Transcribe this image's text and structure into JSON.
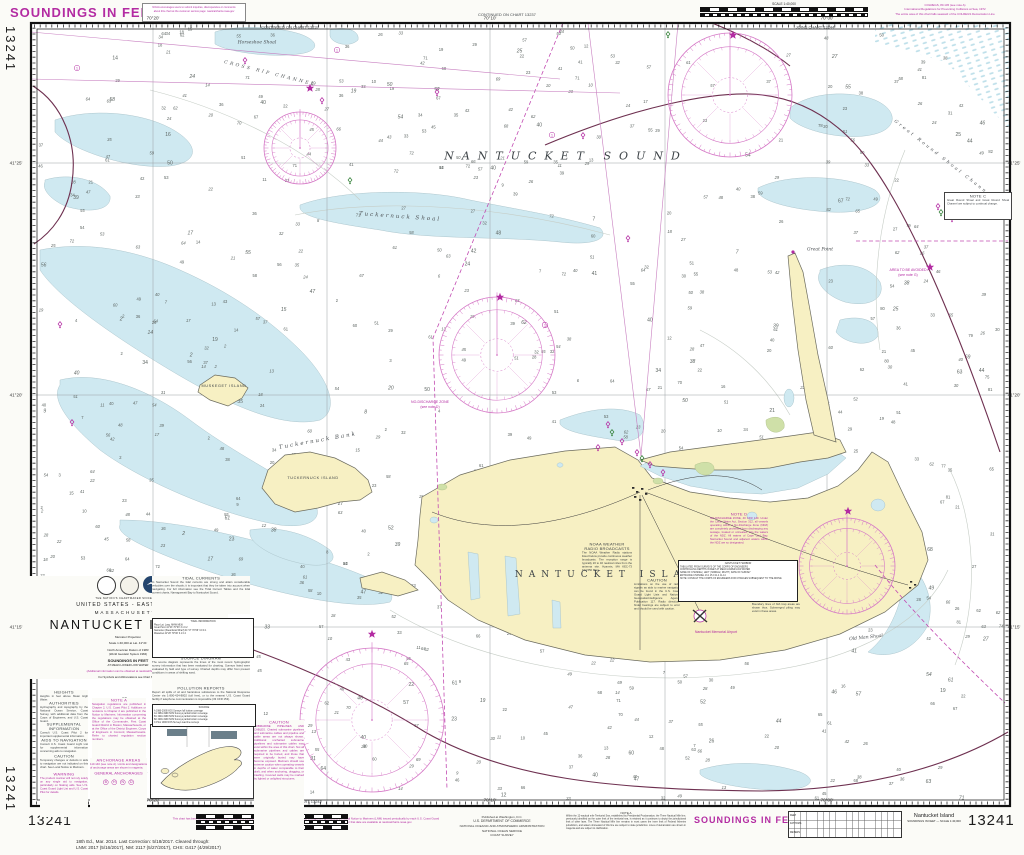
{
  "page": {
    "chart_number": "13241",
    "soundings_margin": "SOUNDINGS IN FEET"
  },
  "colors": {
    "magenta": "#b32ba2",
    "rose": "#d578c6",
    "dashed": "#c24cb2",
    "water": "#cfe9f1",
    "land": "#f7f0c3",
    "marsh": "#cfe0a8",
    "cable": "#6e3050",
    "sounding": "#5e6663",
    "paper": "#fbfbf7"
  },
  "top": {
    "note_box_line1": "NOAA encourages users to submit inquiries, discrepancies or comments",
    "note_box_line2": "about this chart at the customer service page: nauticalcharts.noaa.gov",
    "continued": "CONTINUED ON CHART 13237",
    "joins": "JOINS CHART 13244",
    "scale_label": "SCALE  1:40,000",
    "colregs_line1": "COLREGS, 80.145 (see note A)",
    "colregs_line2": "International Regulations for Preventing Collisions at Sea, 1972",
    "colregs_line3": "The entire area of this chart falls seaward of the COLREGS Demarcation Line"
  },
  "title_block": {
    "motto": "THE NATION'S CHARTMAKER SINCE 1807",
    "region1": "UNITED STATES - EAST COAST",
    "region2": "MASSACHUSETTS",
    "title": "NANTUCKET ISLAND",
    "projection": "Mercator Projection",
    "scale": "Scale 1:40,000 at Lat. 41°21'",
    "datum1": "North American Datum of 1983",
    "datum2": "(World Geodetic System 1984)",
    "sound_unit": "SOUNDINGS IN FEET",
    "sound_datum": "AT MEAN LOWER LOW WATER",
    "web_note": "(Additional information can be obtained at nauticalcharts.noaa.gov)",
    "symbols_note": "For Symbols and Abbreviations see Chart No. 1"
  },
  "bottom": {
    "chart_number_left": "13241",
    "chart_number_right": "13241",
    "soundings": "SOUNDINGS IN FEET",
    "caution_title": "CAUTION",
    "caution_body": "This chart has been corrected from the Notice to Mariners (NM) published weekly by the National Geospatial-Intelligence Agency, and the Local Notice to Mariners (LNM) issued periodically by each U.S. Coast Guard district to the date shown in the lower left hand corner. Chart updates contained in the Notice to Mariners and issued after that date are available at nauticalcharts.noaa.gov.",
    "publisher1": "Published at Washington, D.C.",
    "publisher2": "U.S. DEPARTMENT OF COMMERCE",
    "publisher3": "NATIONAL OCEANIC AND ATMOSPHERIC ADMINISTRATION",
    "publisher4": "NATIONAL OCEAN SERVICE",
    "publisher5": "COAST SURVEY",
    "note_a_title": "NOTE A",
    "note_a_body": "Within the 12-nautical mile Territorial Sea, established by Presidential Proclamation, the Three Nautical Mile line, previously identified as the outer limit of the territorial sea, is retained as it continues to depict the jurisdictional limit of other laws. The Three Nautical Mile line remains in most cases the inner limit of Federal fisheries jurisdiction, and waters shoreward of this line are subject to state jurisdiction. Lines of demarcation are shown in magenta and are subject to clarification.",
    "edition_line1": "18th Ed., Mar. 2014. Last Correction: 5/18/2017. Cleared through:",
    "edition_line2": "LNM: 2017 (5/16/2017), NM: 2117 (5/27/2017), CHS: G417 (4/29/2017)",
    "right_title1": "Nantucket Island",
    "right_title2": "SOUNDINGS IN FEET — SCALE 1:40,000",
    "continued": "CONTINUED ON CHART 13242",
    "scale_label": "SCALE  1:40,000",
    "scale_units1": "Nautical Miles",
    "scale_units2": "Yards",
    "scale_units3": "Meters",
    "conv_row1": "FEET",
    "conv_row2": "FATHOMS",
    "conv_row3": "METERS"
  },
  "labels": [
    {
      "t": "NANTUCKET SOUND",
      "x": 566,
      "y": 156,
      "c": "sea-major",
      "r": 0
    },
    {
      "t": "NANTUCKET ISLAND",
      "x": 614,
      "y": 575,
      "c": "land-major",
      "r": 0
    },
    {
      "t": "Horseshoe Shoal",
      "x": 257,
      "y": 43,
      "c": "shoal",
      "r": 0
    },
    {
      "t": "CROSS RIP CHANNEL",
      "x": 270,
      "y": 74,
      "c": "channel",
      "r": 14
    },
    {
      "t": "Tuckernuck Shoal",
      "x": 400,
      "y": 217,
      "c": "shoal-lg",
      "r": 4
    },
    {
      "t": "Tuckernuck Bank",
      "x": 318,
      "y": 441,
      "c": "shoal-lg",
      "r": -10
    },
    {
      "t": "MUSKEGET ISLAND",
      "x": 224,
      "y": 386,
      "c": "isl",
      "r": 0
    },
    {
      "t": "TUCKERNUCK ISLAND",
      "x": 313,
      "y": 478,
      "c": "isl",
      "r": 0
    },
    {
      "t": "Great Point",
      "x": 820,
      "y": 250,
      "c": "shoal",
      "r": 0
    },
    {
      "t": "Old Man Shoal",
      "x": 866,
      "y": 638,
      "c": "shoal",
      "r": -6
    },
    {
      "t": "Great Round Shoal Channel",
      "x": 944,
      "y": 160,
      "c": "channel",
      "r": 38
    },
    {
      "t": "Nantucket Memorial Airport",
      "x": 716,
      "y": 632,
      "c": "tiny-mag",
      "r": 0
    },
    {
      "t": "NO-DISCHARGE ZONE",
      "x": 430,
      "y": 402,
      "c": "tiny-mag",
      "r": 0
    },
    {
      "t": "(see note D)",
      "x": 430,
      "y": 407,
      "c": "tiny-mag",
      "r": 0
    },
    {
      "t": "AREA TO BE AVOIDED",
      "x": 908,
      "y": 270,
      "c": "tiny-mag",
      "r": 0
    },
    {
      "t": "(see note G)",
      "x": 908,
      "y": 275,
      "c": "tiny-mag",
      "r": 0
    },
    {
      "t": "CONTINUED ON CHART 13237",
      "x": 290,
      "y": 27,
      "c": "tinytext",
      "r": 0
    },
    {
      "t": "JOINS CHART 13244",
      "x": 815,
      "y": 27,
      "c": "tinytext",
      "r": 0
    }
  ],
  "edge_labels": [
    {
      "t": "70°20'",
      "x": 153,
      "y": 18
    },
    {
      "t": "70°10'",
      "x": 490,
      "y": 18
    },
    {
      "t": "70°00'",
      "x": 827,
      "y": 18
    },
    {
      "t": "70°20'",
      "x": 153,
      "y": 800
    },
    {
      "t": "70°10'",
      "x": 490,
      "y": 800
    },
    {
      "t": "70°00'",
      "x": 827,
      "y": 800
    },
    {
      "t": "41°25'",
      "x": 16,
      "y": 163
    },
    {
      "t": "41°20'",
      "x": 16,
      "y": 395
    },
    {
      "t": "41°15'",
      "x": 16,
      "y": 627
    },
    {
      "t": "41°25'",
      "x": 1014,
      "y": 163
    },
    {
      "t": "41°20'",
      "x": 1014,
      "y": 395
    },
    {
      "t": "41°15'",
      "x": 1014,
      "y": 627
    }
  ],
  "notes": [
    {
      "x": 40,
      "y": 690,
      "w": 48,
      "color": "k",
      "bg": "p",
      "title": "HEIGHTS",
      "body": "Heights in feet above Mean High Water."
    },
    {
      "x": 40,
      "y": 701,
      "w": 48,
      "color": "k",
      "bg": "p",
      "title": "AUTHORITIES",
      "body": "Hydrography and topography by the National Ocean Service, Coast Survey, with additional data from the Corps of Engineers, and U.S. Coast Guard."
    },
    {
      "x": 40,
      "y": 722,
      "w": 48,
      "color": "k",
      "bg": "p",
      "title": "SUPPLEMENTAL INFORMATION",
      "body": "Consult U.S. Coast Pilot 2 for important supplemental information."
    },
    {
      "x": 40,
      "y": 738,
      "w": 48,
      "color": "k",
      "bg": "p",
      "title": "AIDS TO NAVIGATION",
      "body": "Consult U.S. Coast Guard Light List for supplemental information concerning aids to navigation."
    },
    {
      "x": 40,
      "y": 754,
      "w": 48,
      "color": "k",
      "bg": "p",
      "title": "CAUTION",
      "body": "Temporary changes or defects in aids to navigation are not indicated on this chart. See Local Notice to Mariners."
    },
    {
      "x": 40,
      "y": 772,
      "w": 48,
      "color": "m",
      "bg": "p",
      "title": "WARNING",
      "body": "The prudent mariner will not rely solely on any single aid to navigation, particularly on floating aids. See U.S. Coast Guard Light List and U.S. Coast Pilot for details."
    },
    {
      "x": 92,
      "y": 698,
      "w": 54,
      "color": "m",
      "bg": "p",
      "title": "NOTE A",
      "body": "Navigation regulations are published in Chapter 2, U.S. Coast Pilot 2. Additions or revisions to Chapter 2 are published in the Notice to Mariners. Information concerning the regulations may be obtained at the Office of the Commander, First Coast Guard District in Boston, Massachusetts, or at the Office of the District Engineer, Corps of Engineers in Concord, Massachusetts. Refer to charted regulation section numbers."
    },
    {
      "x": 90,
      "y": 758,
      "w": 57,
      "color": "m",
      "bg": "p",
      "title": "ANCHORAGE AREAS",
      "body": "110.140 (see note A). Limits and designations of anchorage areas are shown in magenta.",
      "foot": "GENERAL ANCHORAGES",
      "foot_circles": [
        "B",
        "H",
        "N",
        "D"
      ]
    },
    {
      "x": 152,
      "y": 576,
      "w": 98,
      "color": "k",
      "bg": "p",
      "title": "TIDAL CURRENTS",
      "body": "In Nantucket Sound the tidal currents are strong and attain considerable velocities over the shoals; it is important that they be taken into account when navigating. For full information see the Tidal Current Tables and the tidal current charts, Narragansett Bay to Nantucket Sound."
    },
    {
      "x": 152,
      "y": 656,
      "w": 98,
      "color": "k",
      "bg": "p",
      "title": "SOURCE DIAGRAM",
      "body": "The source diagram represents the times of the most recent hydrographic survey information that has been evaluated for charting. Surveys listed were evaluated by field and type of survey. Charted depths may differ from present conditions in areas of shifting sand."
    },
    {
      "x": 152,
      "y": 686,
      "w": 98,
      "color": "k",
      "bg": "p",
      "title": "POLLUTION REPORTS",
      "body": "Report all spills of oil and hazardous substances to the National Response Center via 1-800-424-8802 (toll free), or to the nearest U.S. Coast Guard facility if telephone communication is impossible (33 CFR 153)."
    },
    {
      "x": 254,
      "y": 720,
      "w": 50,
      "color": "m",
      "bg": "p",
      "title": "CAUTION",
      "body": "SUBMARINE PIPELINES AND CABLES. Charted submarine pipelines and submarine cables and pipeline and cable areas are not always shown. Additional uncharted submarine pipelines and submarine cables may exist within the area of this chart. Not all submarine pipelines and cables are required to be buried, and those that were originally buried may have become exposed. Mariners should use extreme caution when operating vessels in depths of water comparable to their draft, and when anchoring, dragging, or trawling. Covered wells may be marked by lighted or unlighted structures."
    },
    {
      "x": 944,
      "y": 192,
      "w": 62,
      "color": "k",
      "bg": "w",
      "title": "NOTE C",
      "body": "Great Round Shoal and Great Round Shoal Channel are subject to continual change."
    },
    {
      "x": 710,
      "y": 512,
      "w": 58,
      "color": "m",
      "bg": "t",
      "title": "NOTE D",
      "body": "NO-DISCHARGE ZONE, 40 CFR 140. Under the Clean Water Act, Section 312, all vessels operating within a No-Discharge Zone (NDZ) are completely prohibited from discharging any sewage, treated or untreated, into the waters of the NDZ. All waters of Cape Cod Bay, Nantucket Sound and adjacent waters within the NDZ are so designated."
    },
    {
      "x": 582,
      "y": 542,
      "w": 50,
      "color": "k",
      "bg": "t",
      "title": "NOAA WEATHER RADIO BROADCASTS",
      "body": "The NOAA Weather Radio stations listed below provide continuous weather broadcasts. The reception range is typically 20 to 40 nautical miles from the antenna site. Hyannis, MA   KEC-73   162.550 MHz"
    },
    {
      "x": 634,
      "y": 578,
      "w": 46,
      "color": "k",
      "bg": "t",
      "title": "CAUTION",
      "body": "Limitations on the use of radio signals as aids to marine navigation can be found in the U.S. Coast Guard Light Lists and National Geospatial-Intelligence Agency Publication 117. Radio direction-finder bearings are subject to error and should be used with caution."
    },
    {
      "x": 752,
      "y": 598,
      "w": 48,
      "color": "k",
      "bg": "t",
      "title": "FISH TRAP AREAS",
      "body": "Boundary lines of fish trap areas are shown thus. Submerged piling may exist in these areas."
    }
  ],
  "tables": [
    {
      "x": 152,
      "y": 618,
      "w": 98,
      "h": 36,
      "bg": "w",
      "rows": [
        "TIDAL INFORMATION",
        "Place                  Lat.        Long.     MHW   MLW",
        "Great Point            41°23'    70°03'     3.1     0.2",
        "Nantucket (Steamboat Wharf) 41°17' 70°06'   3.0     0.1",
        "Wauwinet               41°20'    70°00'     3.1     0.2"
      ]
    },
    {
      "x": 152,
      "y": 704,
      "w": 100,
      "h": 19,
      "bg": "w",
      "rows": [
        "SOURCE",
        "A    1980-2009   NOS Surveys    full bottom coverage",
        "A1  1984-1999   NOS Surveys    partial bottom coverage",
        "B1  1940-1969   NOS Surveys    partial bottom coverage",
        "B2  1900-1939   NOS Surveys    partial bottom coverage",
        "C    Prior 1900   NOS Surveys    lead line surveys"
      ]
    },
    {
      "x": 678,
      "y": 560,
      "w": 116,
      "h": 38,
      "bg": "w",
      "rows": [
        "NANTUCKET HARBOR",
        "TABULATED FROM SURVEYS OF THE CORPS OF ENGINEERS",
        "CONTROLLING DEPTHS IN FEET AT MEAN LOWER LOW WATER",
        "NAME OF CHANNEL | LEFT | MIDDLE | RIGHT | DATE OF SURVEY",
        "ENTRANCE CHANNEL   13.1   15.0   11.4   11-14",
        "NOTE: CONSULT THE CORPS OF ENGINEERS FOR CHANGES SUBSEQUENT TO THE ABOVE"
      ]
    }
  ],
  "symbols": {
    "roses": [
      {
        "cx": 730,
        "cy": 95,
        "r": 62
      },
      {
        "cx": 497,
        "cy": 355,
        "r": 58
      },
      {
        "cx": 372,
        "cy": 720,
        "r": 72
      },
      {
        "cx": 847,
        "cy": 566,
        "r": 48
      },
      {
        "cx": 300,
        "cy": 148,
        "r": 36
      }
    ],
    "stars": [
      [
        310,
        88
      ],
      [
        500,
        297
      ],
      [
        733,
        35
      ],
      [
        848,
        511
      ],
      [
        930,
        267
      ],
      [
        372,
        634
      ]
    ],
    "buoys_mag": [
      [
        245,
        60
      ],
      [
        322,
        100
      ],
      [
        437,
        92
      ],
      [
        628,
        238
      ],
      [
        583,
        135
      ],
      [
        938,
        206
      ],
      [
        952,
        218
      ],
      [
        60,
        324
      ],
      [
        72,
        422
      ],
      [
        608,
        424
      ],
      [
        622,
        441
      ],
      [
        637,
        452
      ],
      [
        650,
        464
      ],
      [
        598,
        447
      ],
      [
        663,
        472
      ]
    ],
    "buoys_grn": [
      [
        350,
        180
      ],
      [
        612,
        432
      ],
      [
        642,
        458
      ],
      [
        941,
        212
      ],
      [
        668,
        34
      ]
    ],
    "circles": [
      [
        337,
        50
      ],
      [
        77,
        68
      ],
      [
        552,
        135
      ],
      [
        545,
        325
      ]
    ]
  },
  "soundings": {
    "count": 780,
    "min": 6,
    "max": 72,
    "seed": 1234
  }
}
